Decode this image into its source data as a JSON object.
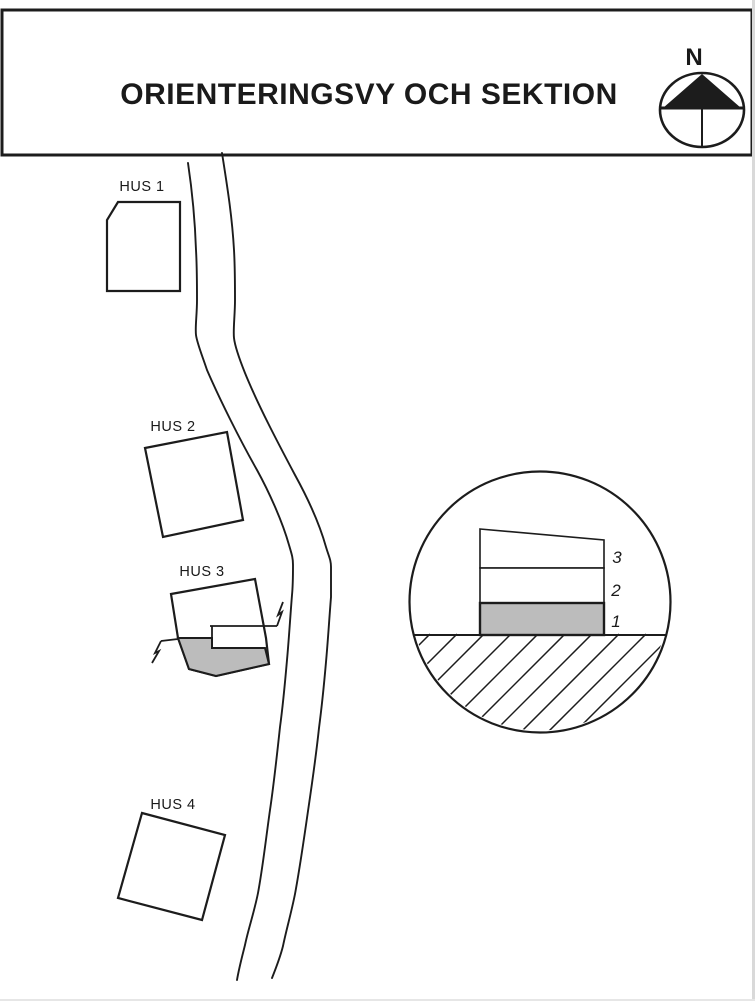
{
  "title": "ORIENTERINGSVY OCH SEKTION",
  "compass": {
    "north_label": "N"
  },
  "site_plan": {
    "buildings": [
      {
        "id": "hus1",
        "label": "HUS 1"
      },
      {
        "id": "hus2",
        "label": "HUS 2"
      },
      {
        "id": "hus3",
        "label": "HUS 3"
      },
      {
        "id": "hus4",
        "label": "HUS 4"
      }
    ]
  },
  "section_detail": {
    "floors": [
      {
        "number": "3"
      },
      {
        "number": "2"
      },
      {
        "number": "1"
      }
    ]
  },
  "colors": {
    "line": "#1c1c1c",
    "shaded_floor": "#bcbcbc",
    "background": "#ffffff"
  }
}
